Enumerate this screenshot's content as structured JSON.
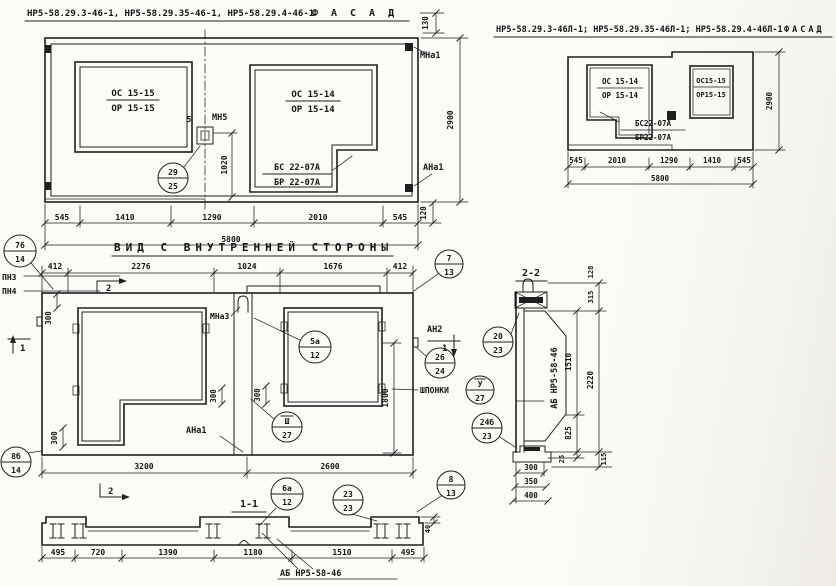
{
  "drawing": {
    "ink": "#1f1f1f",
    "paper": "#fcfbf8"
  },
  "facade_left": {
    "title": "НР5-58.29.3-46-1, НР5-58.29.35-46-1, НР5-58.29.4-46-1",
    "title_view": "ФАСАД",
    "window_left": {
      "num": "ОС 15-15",
      "den": "ОР 15-15"
    },
    "window_right": {
      "num": "ОС 15-14",
      "den": "ОР 15-14"
    },
    "sill": {
      "num": "БС 22-07А",
      "den": "БР 22-07А"
    },
    "mark_mn5": "МН5",
    "dim_5": "5",
    "mark_mna1": "МНа1",
    "mark_ana1": "АНа1",
    "dim_130": "130",
    "dim_2900": "2900",
    "dim_120": "120",
    "dim_1020": "1020",
    "bubble_29_25": {
      "num": "29",
      "den": "25"
    },
    "dims_bottom": [
      "545",
      "1410",
      "1290",
      "2010",
      "545"
    ],
    "dim_total": "5800"
  },
  "facade_right": {
    "title": "НР5-58.29.3-46Л-1; НР5-58.29.35-46Л-1; НР5-58.29.4-46Л-1",
    "title_view": "ФАСАД",
    "window_left": {
      "num": "ОС 15-14",
      "den": "ОР 15-14"
    },
    "window_right": {
      "num": "ОС15-15",
      "den": "ОР15-15"
    },
    "sill": {
      "num": "БС22-07А",
      "den": "БР22-07А"
    },
    "dim_2900": "2900",
    "dims_bottom": [
      "545",
      "2010",
      "1290",
      "1410",
      "545"
    ],
    "dim_total": "5800"
  },
  "interior": {
    "title": "ВИД С ВНУТРЕННЕЙ СТОРОНЫ",
    "dims_top": [
      "412",
      "2276",
      "1024",
      "1676",
      "412"
    ],
    "mark_pn3": "ПН3",
    "mark_pn4": "ПН4",
    "mark_mna3": "МНа3",
    "mark_an2": "АН2",
    "mark_ana1": "АНа1",
    "label_shponki": "ШПОНКИ",
    "section_mark_1": "1",
    "section_mark_2": "2",
    "dim_300": "300",
    "dim_1800": "1800",
    "dim_3200": "3200",
    "dim_2600": "2600",
    "bubbles": {
      "b76_14": {
        "num": "76",
        "den": "14"
      },
      "b7_13": {
        "num": "7",
        "den": "13"
      },
      "b5a_12": {
        "num": "5а",
        "den": "12"
      },
      "b26_24": {
        "num": "26",
        "den": "24"
      },
      "bV_27": {
        "num": "У",
        "den": "27"
      },
      "bIII_27": {
        "num": "Ш",
        "den": "27"
      },
      "b8b_14": {
        "num": "8б",
        "den": "14"
      },
      "b6a_12": {
        "num": "6а",
        "den": "12"
      },
      "b23_23": {
        "num": "23",
        "den": "23"
      },
      "b8_13": {
        "num": "8",
        "den": "13"
      },
      "b24b_23": {
        "num": "24б",
        "den": "23"
      }
    }
  },
  "section_2_2": {
    "title": "2-2",
    "label_ab": "АБ НР5-58-46",
    "dim_128": "128",
    "dim_315": "315",
    "dim_1510": "1510",
    "dim_2220": "2220",
    "dim_825": "825",
    "dim_25": "25",
    "dim_115": "115",
    "dim_300": "300",
    "dim_350": "350",
    "dim_400": "400",
    "bubble_20_23": {
      "num": "20",
      "den": "23"
    }
  },
  "section_1_1": {
    "title": "1-1",
    "dims_bottom": [
      "495",
      "720",
      "1390",
      "1180",
      "1510",
      "495"
    ],
    "dim_40": "40",
    "label_ab": "АБ НР5-58-46"
  }
}
